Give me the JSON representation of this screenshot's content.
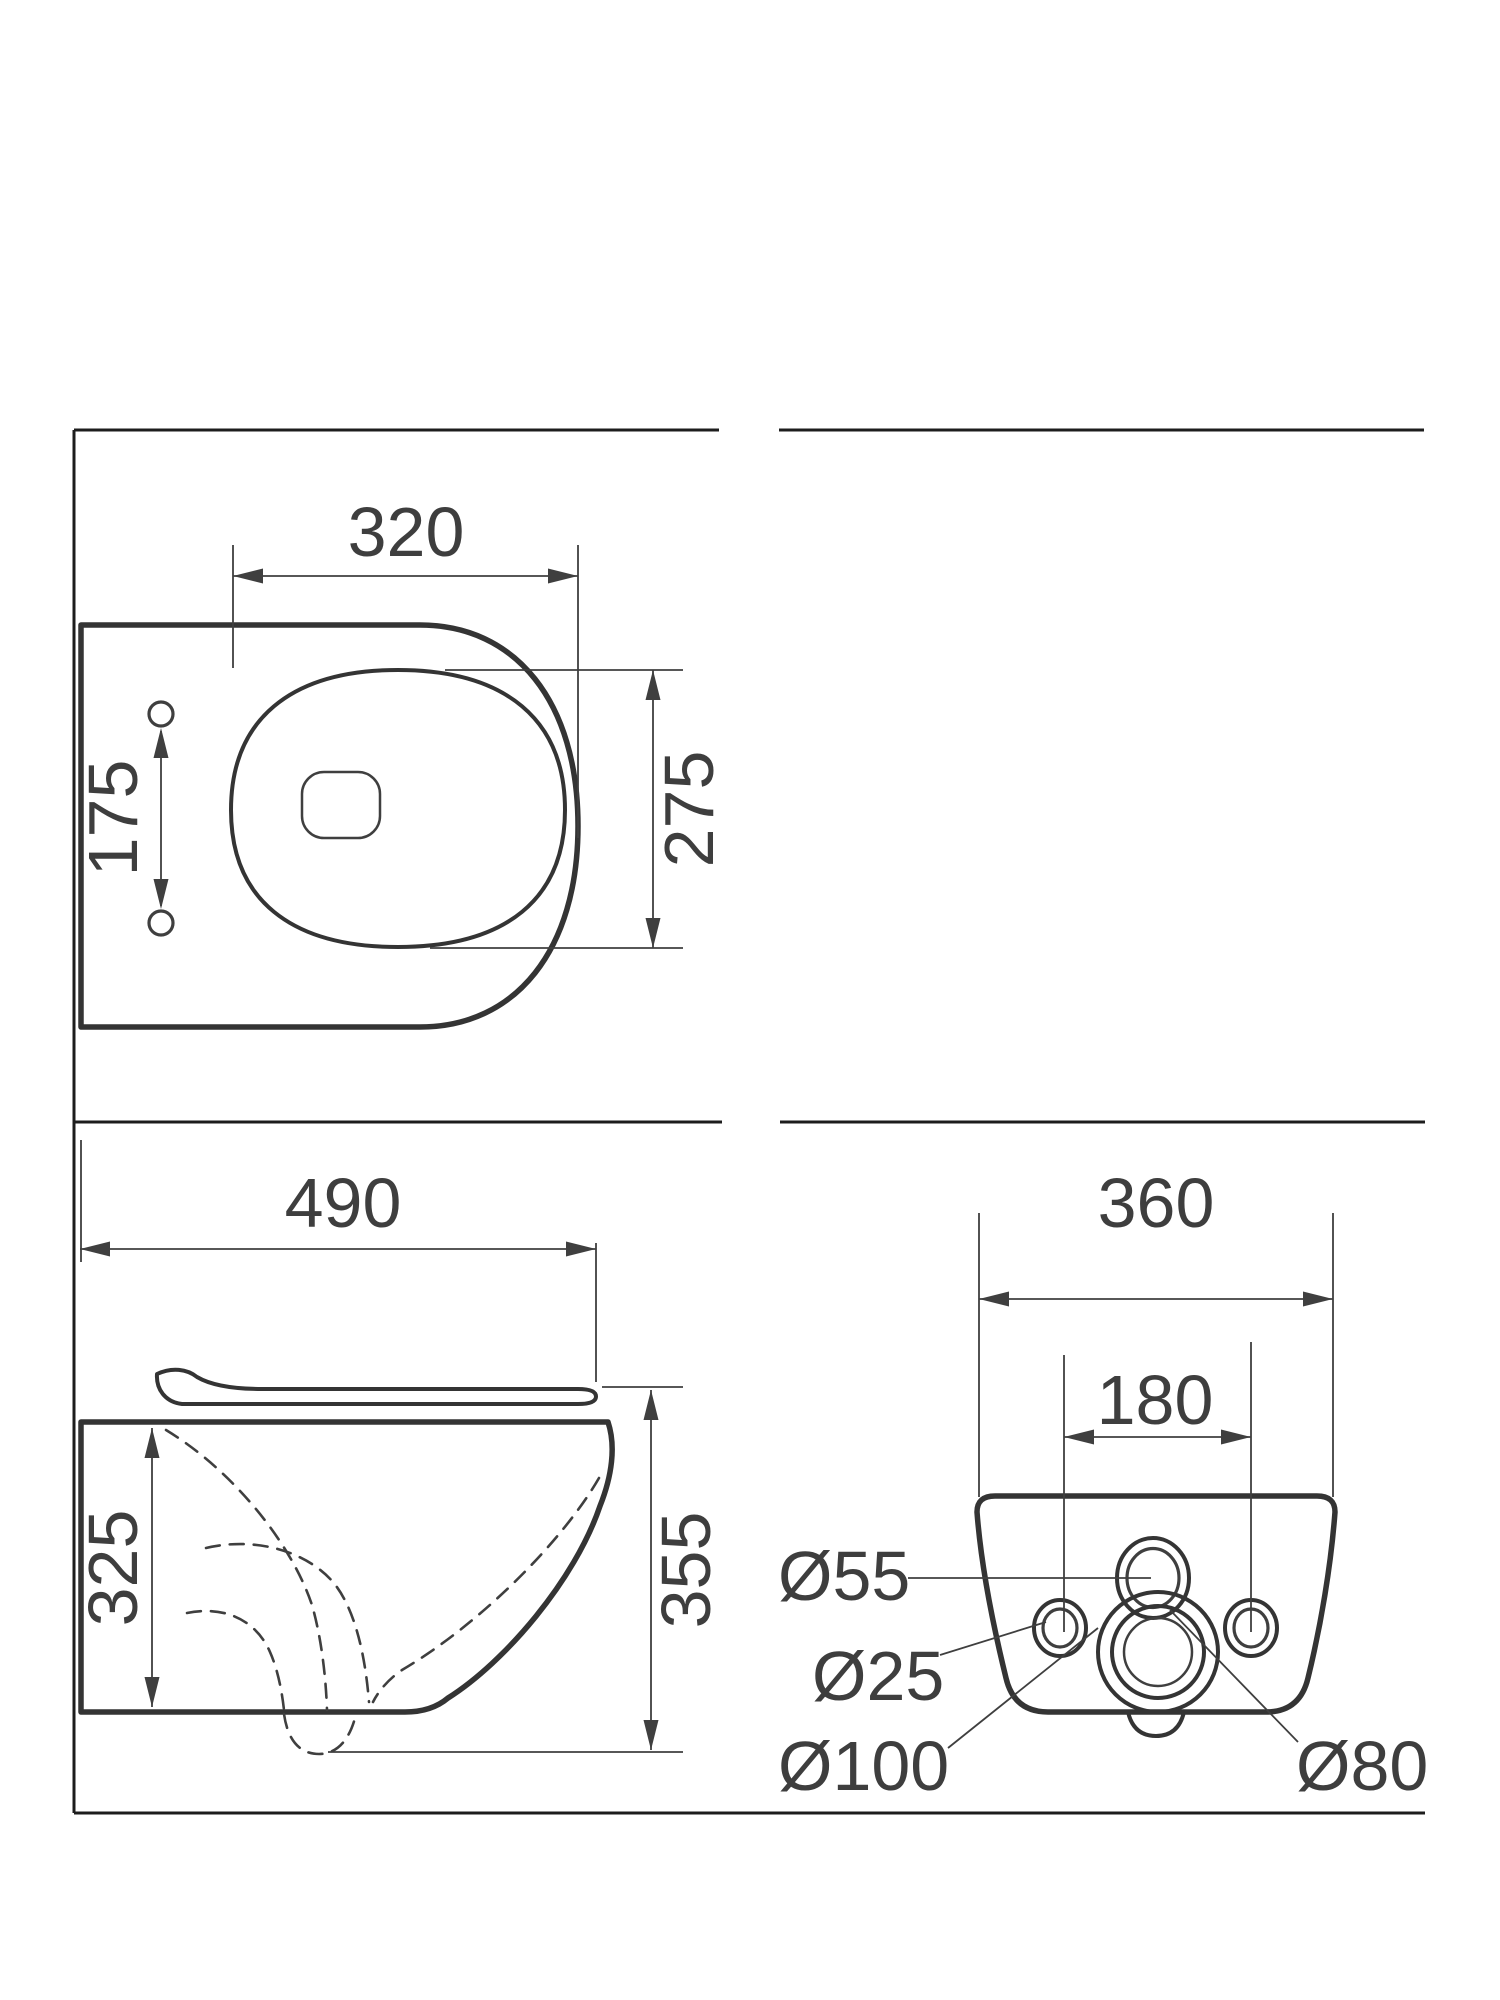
{
  "page": {
    "title": "Wall-hung toilet technical drawing"
  },
  "colors": {
    "line": "#3a3a3a",
    "thick_line": "#343434",
    "frame_line": "#1d1d1d",
    "text": "#3e3e3e",
    "background": "#ffffff"
  },
  "views": {
    "top": {
      "dim_width": "320",
      "dim_bowl_depth": "275",
      "dim_hole_spacing": "175"
    },
    "side": {
      "dim_depth": "490",
      "dim_back_height": "325",
      "dim_total_height": "355"
    },
    "rear": {
      "dim_width": "360",
      "dim_fixing_spacing": "180",
      "dim_top_hole": "Ø55",
      "dim_side_hole": "Ø25",
      "dim_outlet_outer": "Ø100",
      "dim_outlet_inner": "Ø80"
    }
  }
}
